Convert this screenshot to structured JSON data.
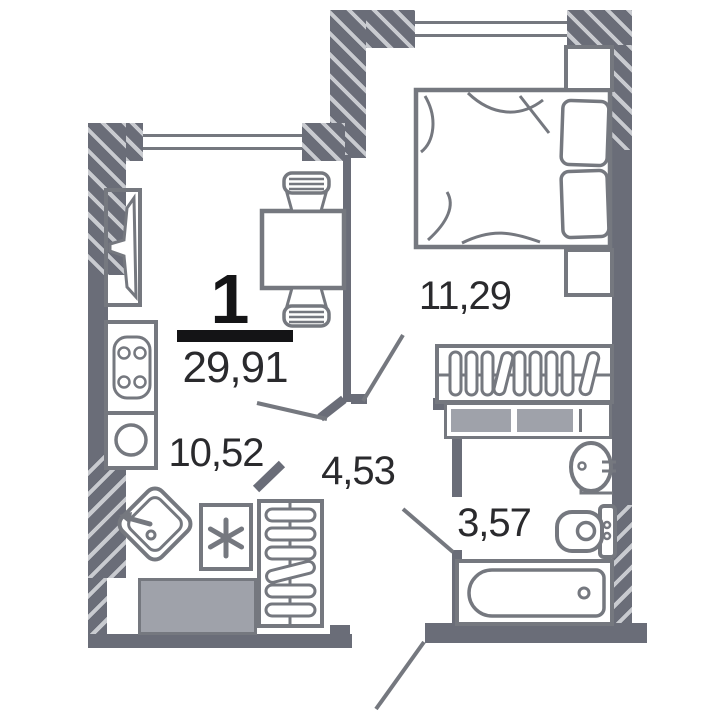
{
  "plan": {
    "summary": {
      "rooms_count": "1",
      "total_area": "29,91"
    },
    "rooms": [
      {
        "id": "bedroom",
        "area": "11,29"
      },
      {
        "id": "kitchen-living",
        "area": "10,52"
      },
      {
        "id": "hall",
        "area": "4,53"
      },
      {
        "id": "bathroom",
        "area": "3,57"
      }
    ]
  },
  "icons": {
    "washer": "asterisk"
  },
  "colors": {
    "wall": "#6a6d78",
    "stripe": "#c9cbd0",
    "furniture": "#75787f",
    "fill_gray": "#9fa2aa",
    "text": "#2a2a2d",
    "ink": "#141416",
    "background": "#ffffff"
  }
}
